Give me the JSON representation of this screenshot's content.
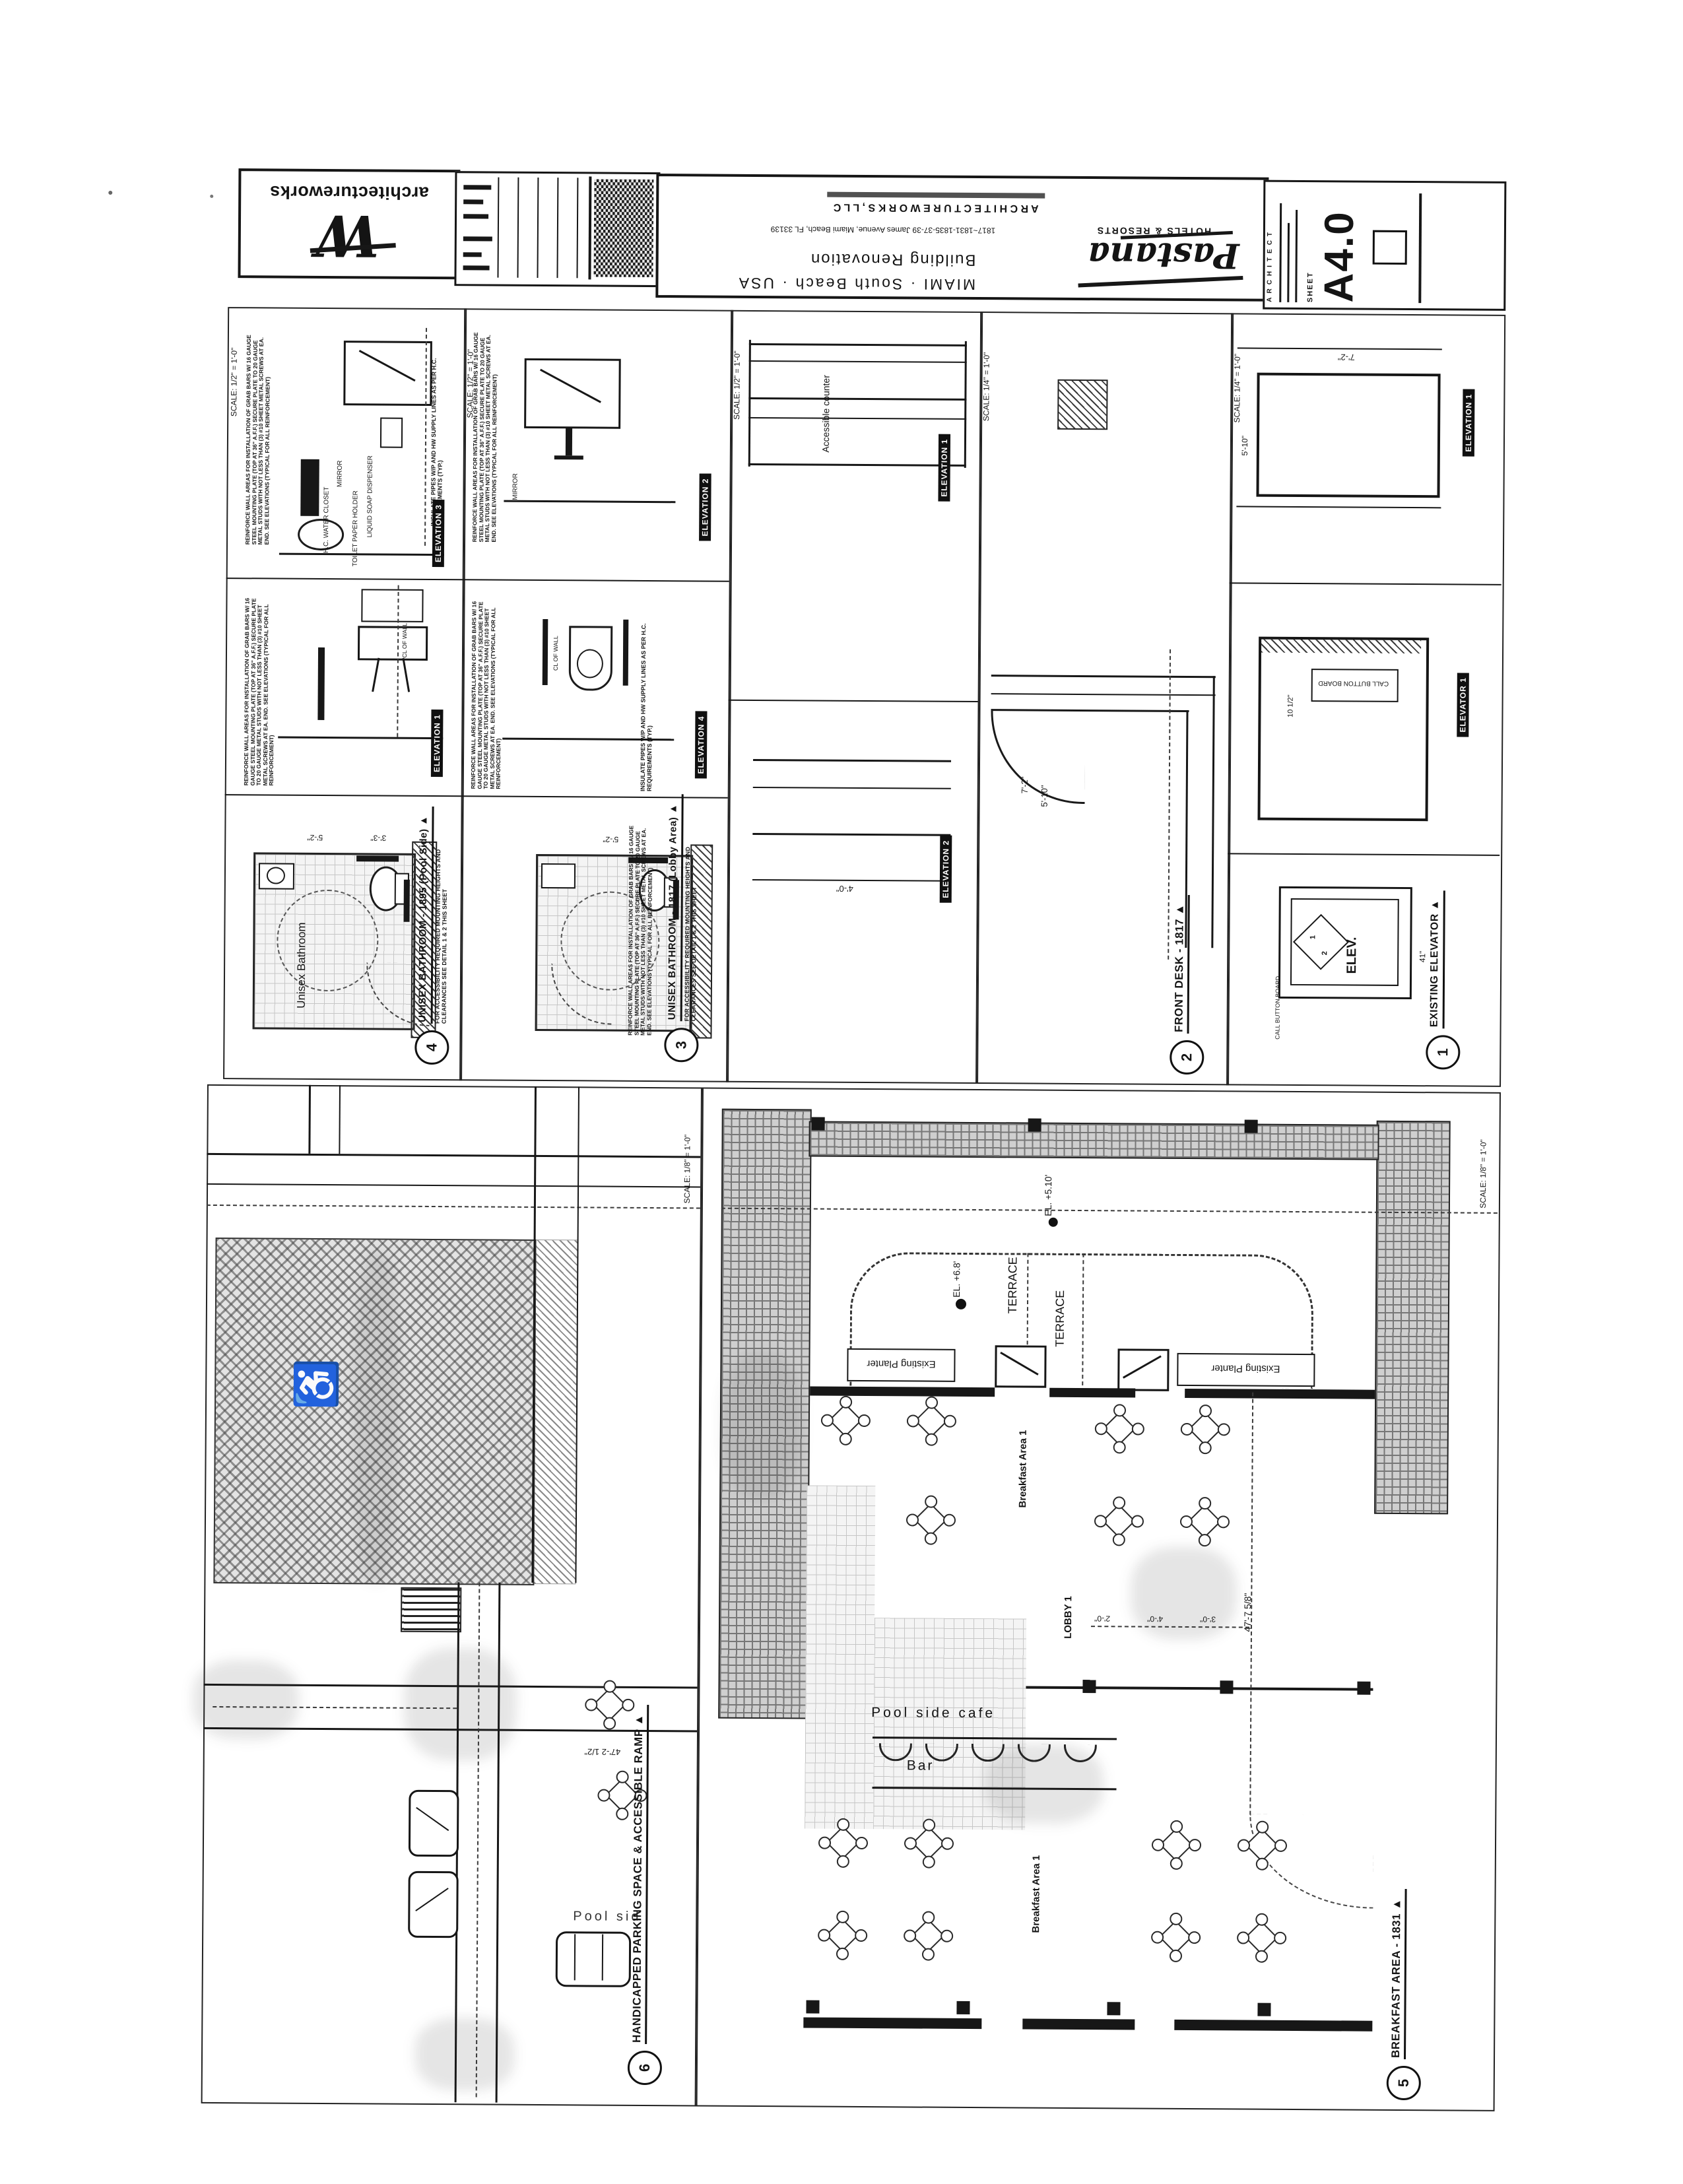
{
  "logo": {
    "name": "architectureworks",
    "mark": "W"
  },
  "icons": {
    "wheelchair": "♿"
  },
  "titleblock": {
    "script_name": "Pastana",
    "subtitle": "HOTELS & RESORTS",
    "address": "1817~1831-1835-37-39 James Avenue, Miami Beach, FL 33139",
    "firm": "A R C H I T E C T U R E W O R K S ,   L L C",
    "project": "Building Renovation",
    "location": "MIAMI  ·  South Beach  ·  USA",
    "architect_label": "ARCHITECT",
    "sheet_label": "SHEET",
    "sheet_number": "A4.0"
  },
  "labels": {
    "d1": {
      "num": "1",
      "title": "EXISTING ELEVATOR ▲"
    },
    "d2": {
      "num": "2",
      "title": "FRONT DESK - 1817 ▲"
    },
    "d3": {
      "num": "3",
      "title": "UNISEX BATHROOM - 1817 (Lobby Area) ▲",
      "note": "FOR ACCESSIBILITY REQUIRED MOUNTING HEIGHTS AND CLEARANCES SEE DETAIL 1 & 2 THIS SHEET"
    },
    "d4": {
      "num": "4",
      "title": "UNISEX BATHROOM - 1895 (Pool Side) ▲",
      "note": "FOR ACCESSIBILITY REQUIRED MOUNTING HEIGHTS AND CLEARANCES SEE DETAIL 1 & 2 THIS SHEET"
    },
    "d5": {
      "num": "5",
      "title": "BREAKFAST AREA - 1831 ▲"
    },
    "d6": {
      "num": "6",
      "title": "HANDICAPPED PARKING SPACE & ACCESSIBLE RAMP ▲"
    }
  },
  "tags": {
    "t1": "ELEVATION 1",
    "t2": "ELEVATION 2",
    "t3": "ELEVATION 3",
    "t4": "ELEVATION 4",
    "t5": "ELEVATOR 1"
  },
  "notes": {
    "reinforce": "REINFORCE WALL AREAS FOR INSTALLATION OF GRAB BARS W/ 16 GAUGE STEEL MOUNTING PLATE (TOP AT 36\" A.F.F.) SECURE PLATE TO 20 GAUGE METAL STUDS WITH NOT LESS THAN (3) #10 SHEET METAL SCREWS AT EA. END. SEE ELEVATIONS (TYPICAL FOR ALL REINFORCEMENT)",
    "insulate": "INSULATE PIPES W/P AND HW SUPPLY LINES AS PER H.C. REQUIREMENTS (TYP.)",
    "mirror": "MIRROR",
    "soap": "LIQUID SOAP DISPENSER",
    "wc": "H.C. WATER CLOSET",
    "tp": "TOILET PAPER HOLDER",
    "cl": "CL OF WALL",
    "call_board": "CALL BUTTON BOARD",
    "accessible": "Accessible counter"
  },
  "plan": {
    "unisex": "Unisex Bathroom",
    "elev": "ELEV.",
    "cab1": "1",
    "cab2": "2",
    "terrace": "TERRACE",
    "planter": "Existing Planter",
    "breakfast": "Breakfast Area 1",
    "lobby": "LOBBY 1",
    "cafe": "Pool side cafe",
    "bar": "Bar",
    "pool_side": "Pool sid",
    "el1": "EL. +5.10'",
    "el2": "EL. +6.8'"
  },
  "dims": {
    "a": "41\"",
    "b": "7'-2\"",
    "c": "5'-10\"",
    "d": "47'-2 1/2\"",
    "e": "47'-7 5/8\"",
    "f": "5'-2\"",
    "g": "3'-3\"",
    "h": "2'-0\"",
    "i": "4'-0\"",
    "j": "3'-0\"",
    "k": "10 1/2\""
  },
  "scales": {
    "q": "SCALE: 1/4\" = 1'-0\"",
    "h": "SCALE: 1/2\" = 1'-0\"",
    "e": "SCALE: 1/8\" = 1'-0\""
  }
}
